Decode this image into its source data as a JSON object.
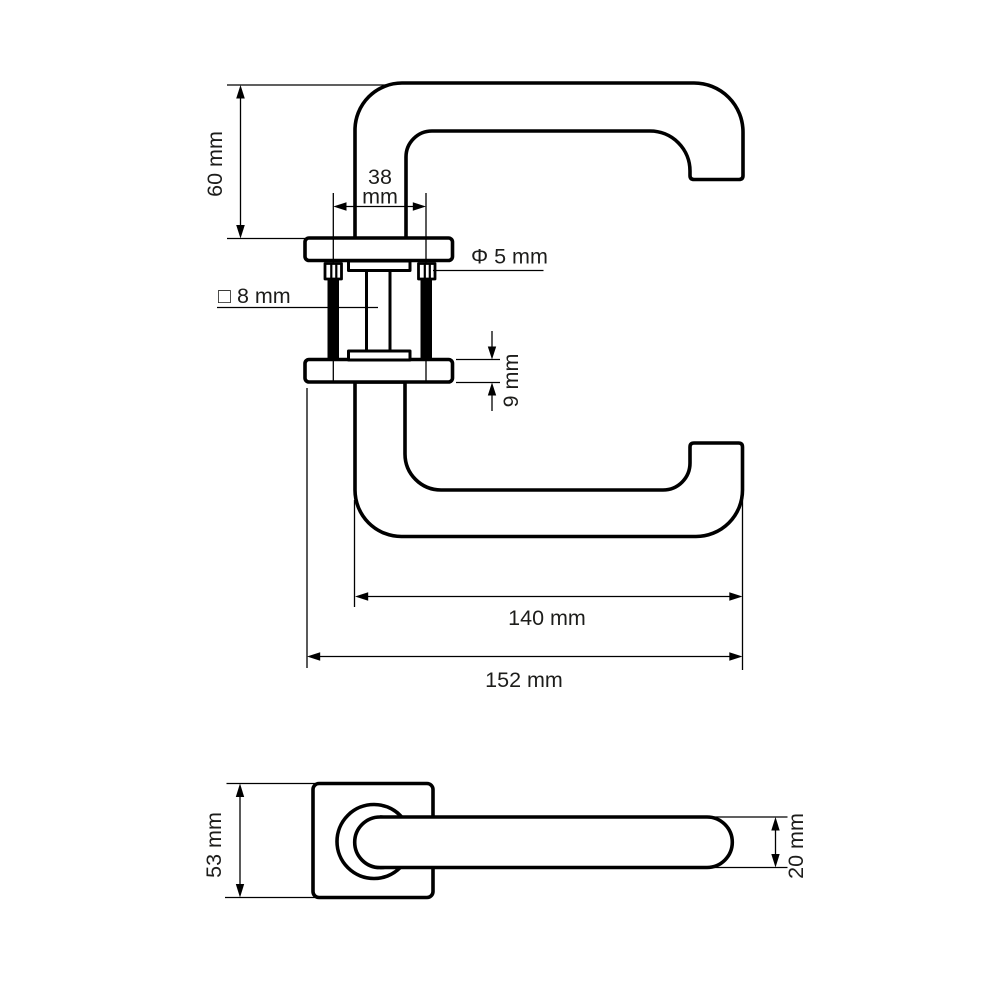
{
  "diagram": {
    "type": "technical-drawing",
    "subject": "door lever handle on square rose, dimensioned side view and front view",
    "colors": {
      "line": "#000000",
      "text": "#1d1d1b",
      "background": "#ffffff"
    },
    "side_view": {
      "dimensions": {
        "handle_height": "60 mm",
        "screw_spacing_line1": "38",
        "screw_spacing_line2": "mm",
        "screw_diameter": "Φ 5 mm",
        "spindle_square": "□ 8 mm",
        "rose_thickness": "9 mm",
        "lever_length": "140 mm",
        "total_length": "152 mm"
      }
    },
    "front_view": {
      "dimensions": {
        "rose_size": "53 mm",
        "lever_diameter": "20 mm"
      }
    }
  }
}
